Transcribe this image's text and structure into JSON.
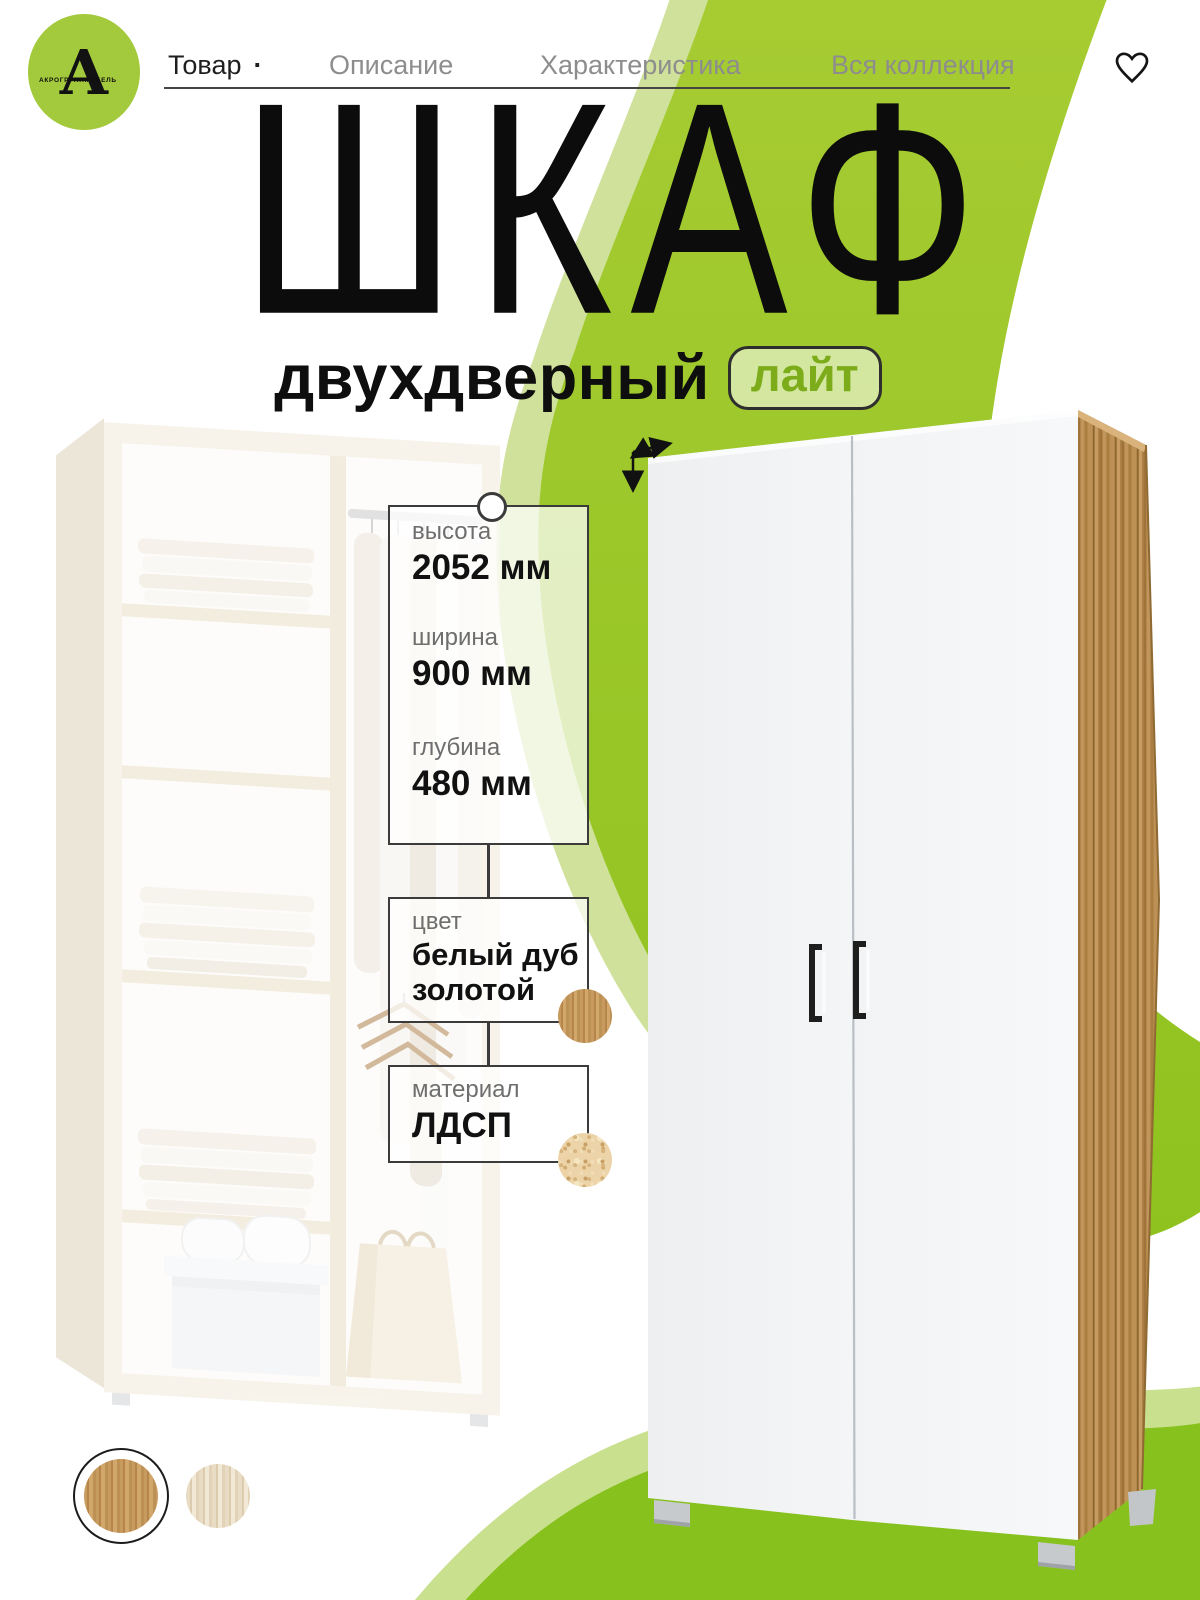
{
  "brand": {
    "monogram": "А",
    "name": "АКРОГРУППМЕБЕЛЬ"
  },
  "nav": {
    "items": [
      {
        "label": "Товар",
        "active": true,
        "dot": "·"
      },
      {
        "label": "Описание",
        "active": false
      },
      {
        "label": "Характеристика",
        "active": false
      },
      {
        "label": "Вся коллекция",
        "active": false
      }
    ]
  },
  "hero": {
    "title": "ШКАФ",
    "subtitle": "двухдверный",
    "badge": "лайт"
  },
  "specs": {
    "pin_box": {
      "rows": [
        {
          "label": "высота",
          "value": "2052 мм"
        },
        {
          "label": "ширина",
          "value": "900 мм"
        },
        {
          "label": "глубина",
          "value": "480 мм"
        }
      ]
    },
    "color": {
      "label": "цвет",
      "value_line1": "белый дуб",
      "value_line2": "золотой"
    },
    "material": {
      "label": "материал",
      "value": "ЛДСП"
    }
  },
  "swatches": {
    "options": [
      {
        "id": "oak-gold",
        "selected": true,
        "swatch_hex": "#c2945a"
      },
      {
        "id": "oak-sonoma",
        "selected": false,
        "swatch_hex": "#e5d7bd"
      }
    ]
  },
  "colors": {
    "green_swoosh": "#9cc32a",
    "green_blob": "#87c11e",
    "green_light": "#cfe19b",
    "logo_green": "#a3c93c",
    "badge_text": "#7cac1a",
    "wood_side": "#b3874a",
    "label_gray": "#6e6e6e",
    "nav_gray": "#8d8d8d",
    "ink": "#0e0e0e"
  }
}
